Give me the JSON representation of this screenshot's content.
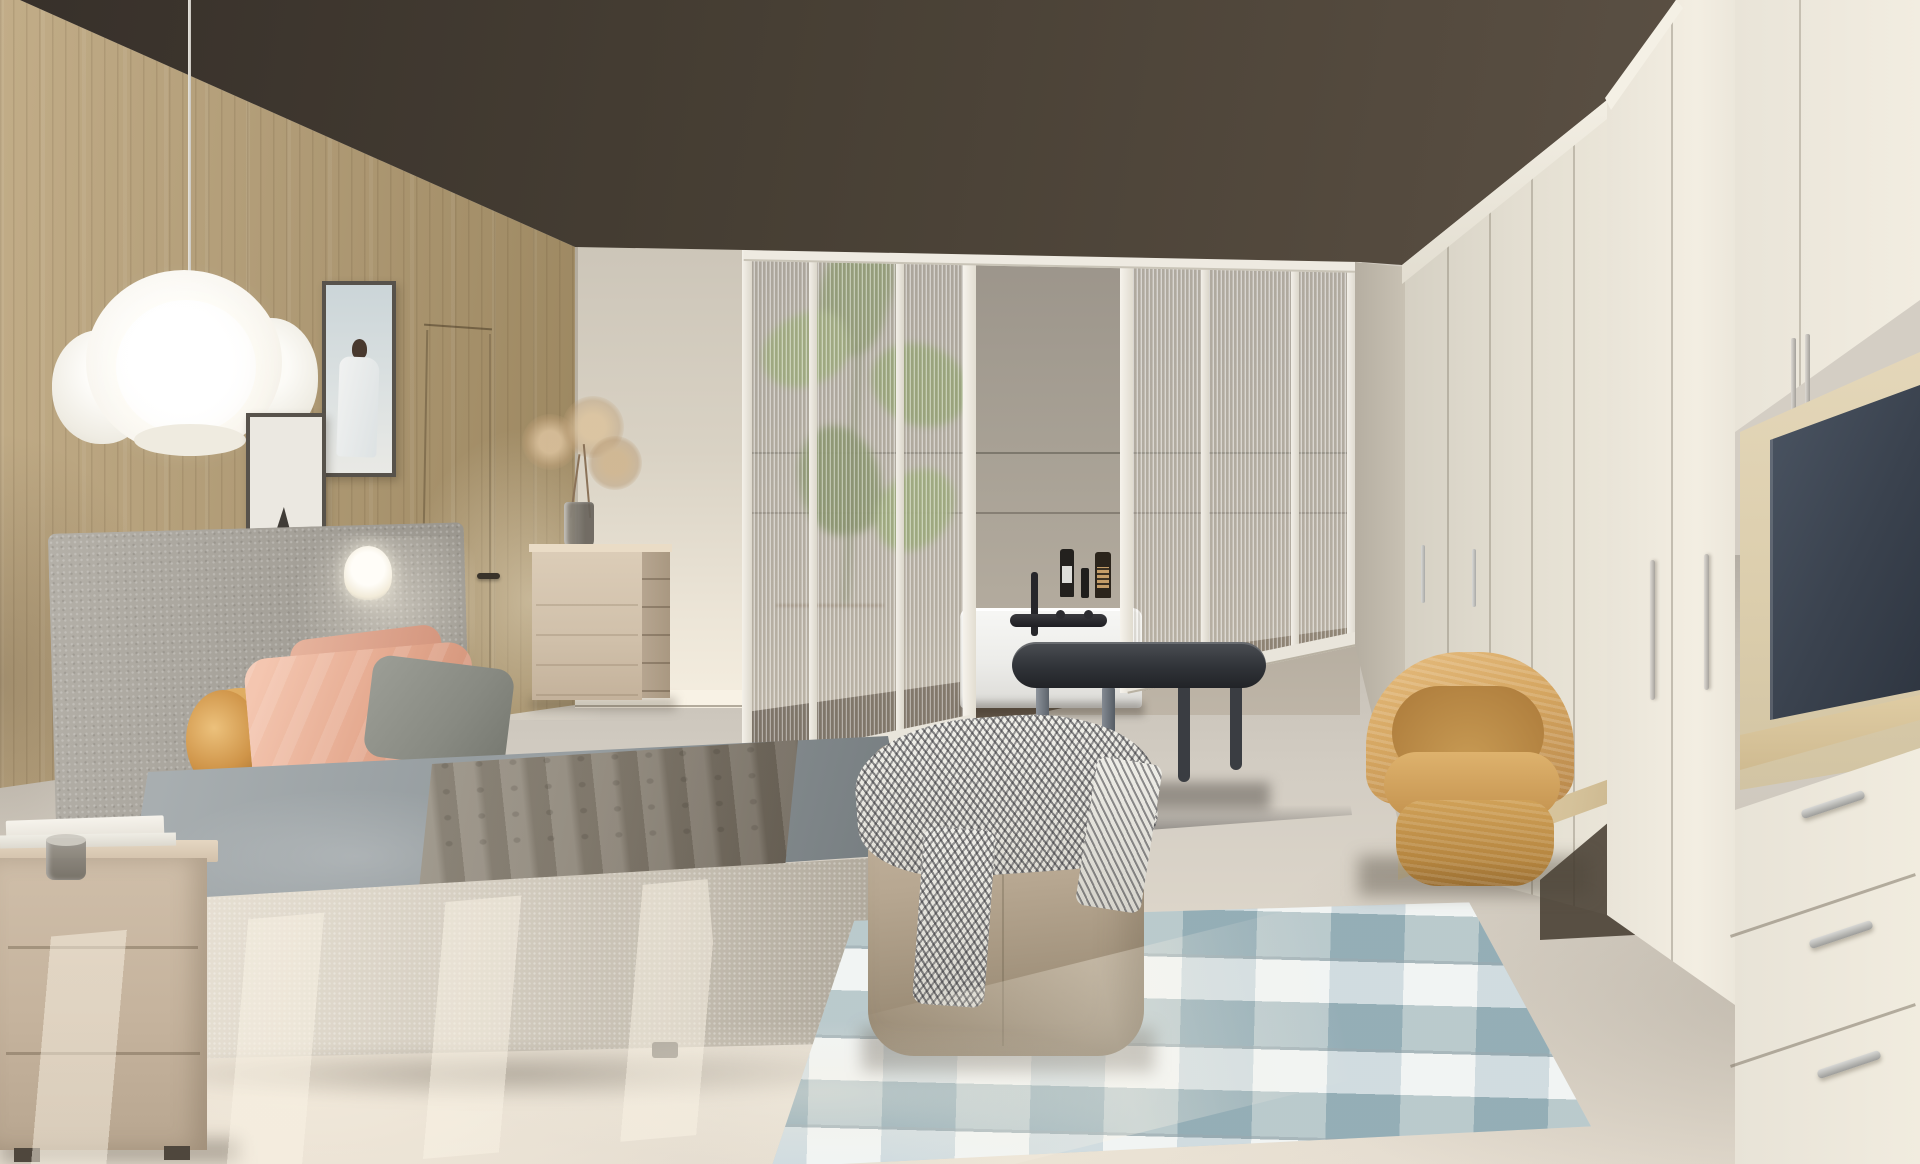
{
  "meta": {
    "type": "photorealistic interior render",
    "subject": "modern scandinavian bedroom with en-suite glimpse behind fluted glass partition",
    "canvas": {
      "width": 1920,
      "height": 1164
    },
    "visible_text": "none"
  },
  "palette": {
    "ceiling_brown": "#4a4136",
    "wood_wall": "#ab9671",
    "back_wall_cream": "#e2dbce",
    "partition_frame_white": "#eeeae1",
    "bathroom_wall_gray": "#a59e92",
    "bathtub_white": "#f3f3f0",
    "faucet_black": "#26262a",
    "bench_charcoal": "#303338",
    "striped_rug_dark": "#2e2e34",
    "striped_rug_light": "#eceae4",
    "plaid_rug_blue": "#9db6bf",
    "plaid_rug_light": "#e2e8e6",
    "pouf_taupe": "#b5a58f",
    "bed_base_boucle": "#d8d1c4",
    "bedspread_gray": "#969da0",
    "blanket_taupe": "#877f72",
    "headboard_gray": "#a5a199",
    "bolster_caramel": "#c98f44",
    "pillow_salmon": "#e3a98f",
    "nightstand_greige": "#c4b29c",
    "dresser_greige": "#cbbba4",
    "wardrobe_cream": "#ece7db",
    "tv_niche_beige": "#ddd0b2",
    "tv_screen_navy": "#39414d",
    "chair_tan": "#d3a45f",
    "floor_warm_gray": "#d4cec4",
    "sunlight": "#f3ecdd",
    "handle_silver": "#c6c6c3",
    "plant_green": "#7d9355"
  },
  "objects": [
    {
      "id": "ceiling",
      "label": "dark brown flat ceiling"
    },
    {
      "id": "wood-wall",
      "label": "vertical oak slat wall behind bed"
    },
    {
      "id": "hidden-door",
      "label": "concealed door with dark lever handle in wood wall"
    },
    {
      "id": "pendant-lamp",
      "label": "white crumpled-paper cloud pendant on long cord"
    },
    {
      "id": "artwork-portrait",
      "label": "framed print, figure in white robe on pale blue"
    },
    {
      "id": "artwork-mountains",
      "label": "framed print, dark mountain shapes on white"
    },
    {
      "id": "headboard",
      "label": "tall gray boucle headboard"
    },
    {
      "id": "table-lamp",
      "label": "small glowing white lamp behind pillows"
    },
    {
      "id": "bolster-cushion",
      "label": "caramel leather cylindrical bolster"
    },
    {
      "id": "pillow-salmon-front",
      "label": "salmon satin pillow"
    },
    {
      "id": "pillow-salmon-back",
      "label": "second salmon pillow"
    },
    {
      "id": "pillow-gray",
      "label": "gray-green accent pillow"
    },
    {
      "id": "bedspread",
      "label": "slate gray fitted bedspread"
    },
    {
      "id": "blanket",
      "label": "taupe quilted throw blanket draped over bed"
    },
    {
      "id": "bed-base",
      "label": "light boucle upholstered bed base"
    },
    {
      "id": "nightstand",
      "label": "greige two-drawer nightstand"
    },
    {
      "id": "books",
      "label": "stack of white books on nightstand"
    },
    {
      "id": "glass-cup",
      "label": "smoked glass cup on books"
    },
    {
      "id": "dresser",
      "label": "greige tall chest beside wall corner"
    },
    {
      "id": "vase",
      "label": "smoked glass vase on dresser"
    },
    {
      "id": "dried-flowers",
      "label": "beige dried flower bouquet"
    },
    {
      "id": "glass-partition",
      "label": "white-framed fluted glass partition to bathroom"
    },
    {
      "id": "partition-doorway",
      "label": "open doorway gap in glass partition"
    },
    {
      "id": "plant",
      "label": "potted plant silhouette behind glass"
    },
    {
      "id": "planter",
      "label": "beige cylindrical planter behind glass"
    },
    {
      "id": "bathtub",
      "label": "white built-in bathtub"
    },
    {
      "id": "bath-faucet",
      "label": "black wall-mounted tub faucet"
    },
    {
      "id": "toiletry-bottles",
      "label": "three amber/black bottles on wall ledge"
    },
    {
      "id": "wall-ledges",
      "label": "two horizontal reveal lines on bathroom wall"
    },
    {
      "id": "bench",
      "label": "charcoal oval bench on striped runner"
    },
    {
      "id": "striped-rug",
      "label": "black and white striped runner"
    },
    {
      "id": "plaid-rug",
      "label": "light blue plaid area rug"
    },
    {
      "id": "pouf",
      "label": "square taupe fabric pouf"
    },
    {
      "id": "herringbone-throw",
      "label": "black-white herringbone throw on pouf"
    },
    {
      "id": "armchair",
      "label": "tan woven barrel swivel chair"
    },
    {
      "id": "desk",
      "label": "floating light-oak vanity desk"
    },
    {
      "id": "desk-books",
      "label": "books, pedestal bowl and dark bottle on desk"
    },
    {
      "id": "wardrobe-run",
      "label": "cream paneled wardrobe run receding right"
    },
    {
      "id": "tall-wardrobe",
      "label": "tall cream wardrobe column with bar handles"
    },
    {
      "id": "tv-unit",
      "label": "built-in TV unit with beige niche"
    },
    {
      "id": "tv",
      "label": "dark navy TV screen"
    },
    {
      "id": "tv-shelves",
      "label": "light oak shelves in niche"
    },
    {
      "id": "drawer-stack",
      "label": "three cream drawers with silver handles"
    },
    {
      "id": "floor",
      "label": "warm gray concrete floor with sun streaks"
    }
  ]
}
